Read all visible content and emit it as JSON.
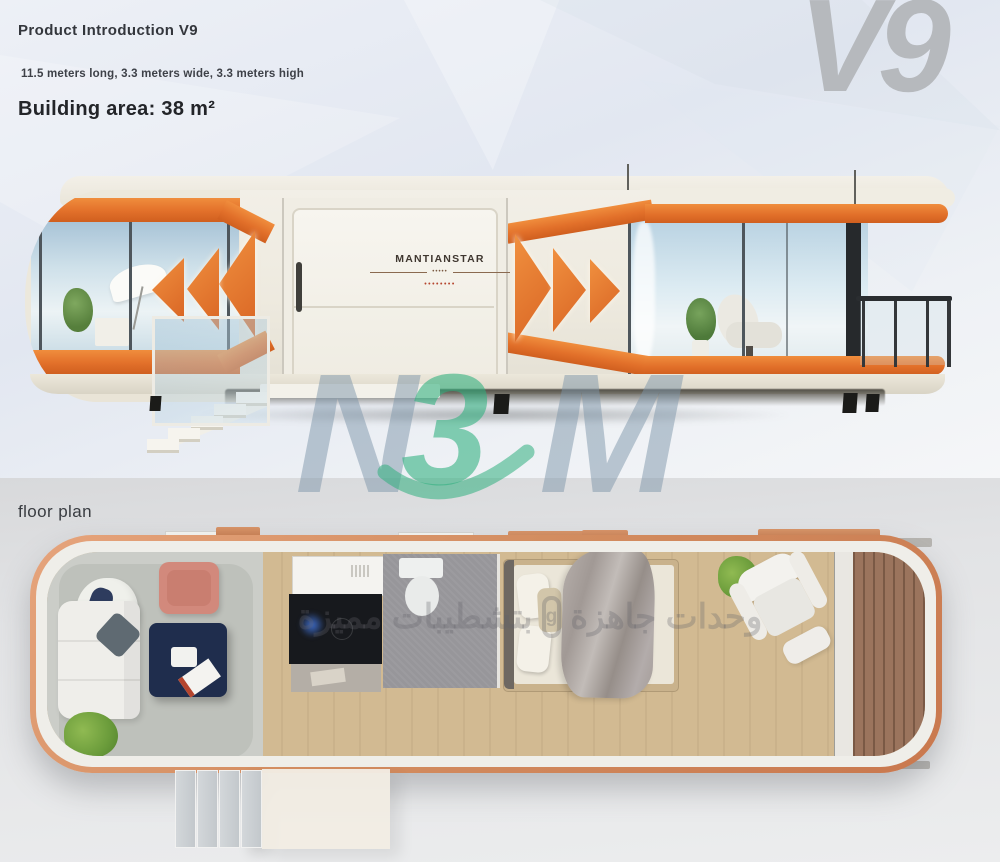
{
  "header": {
    "title": "Product Introduction V9",
    "dimensions": "11.5 meters long, 3.3 meters wide, 3.3 meters high",
    "building_area": "Building area: 38 m²"
  },
  "badge": {
    "model": "V9"
  },
  "building": {
    "brand_name": "MANTIANSTAR",
    "brand_rule_text": "•••••",
    "brand_tagline": "••••••••"
  },
  "floor_plan": {
    "label": "floor plan"
  },
  "watermarks": {
    "logo": {
      "left_letter": "N",
      "digit": "3",
      "right_letter": "M"
    },
    "arabic_lead": "وحدات جاهزة",
    "arabic_glyph": "g",
    "arabic_tail": "بتشطيبات مميزة"
  },
  "colors": {
    "accent_orange": "#E2702A",
    "copper_rim": "#D08C60",
    "logo_green": "#2FAF7D",
    "logo_blue": "#7F98AA",
    "navy_table": "#1F2D4D",
    "salmon_chair": "#D2897C"
  }
}
